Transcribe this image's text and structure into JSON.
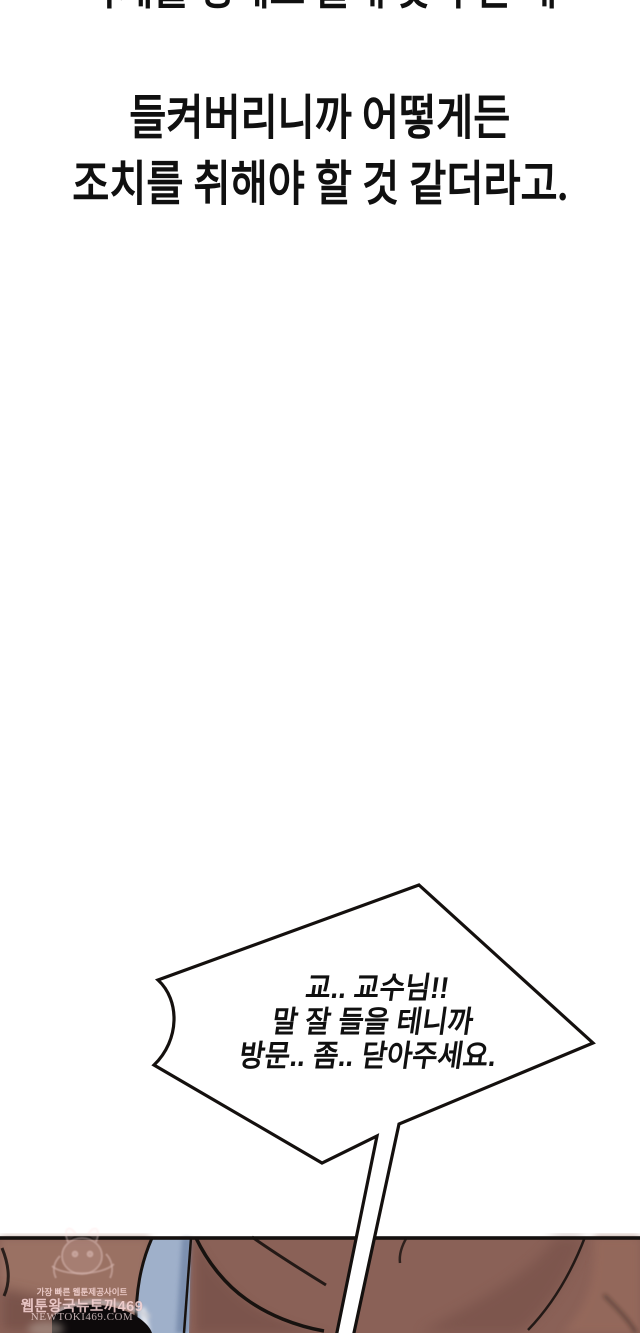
{
  "comic": {
    "narration": {
      "clipped_top_line": "과제를 핑계로 몰래 찾아 온 게",
      "line1": "들켜버리니까 어떻게든",
      "line2": "조치를 취해야 할 것 같더라고."
    },
    "speech_bubble": {
      "line1": "교.. 교수님!!",
      "line2": "말 잘 들을 테니까",
      "line3": "방문.. 좀.. 닫아주세요."
    },
    "watermark": {
      "tagline": "가장 빠른 웹툰제공사이트",
      "site_name": "웹툰왕국뉴토끼469",
      "site_url": "NEWTOKI469.COM"
    },
    "colors": {
      "background": "#FFFFFF",
      "text": "#101010",
      "bubble_fill": "#FFFFFF",
      "bubble_outline": "#14100E",
      "panel_skin": "#8A6157",
      "panel_skin_light": "#9A7163",
      "panel_skin_shadow": "#6E4A42",
      "panel_blue_clothing": "#9FB0CA",
      "panel_hair": "#0D0A0B",
      "panel_outline": "#17120F"
    }
  }
}
